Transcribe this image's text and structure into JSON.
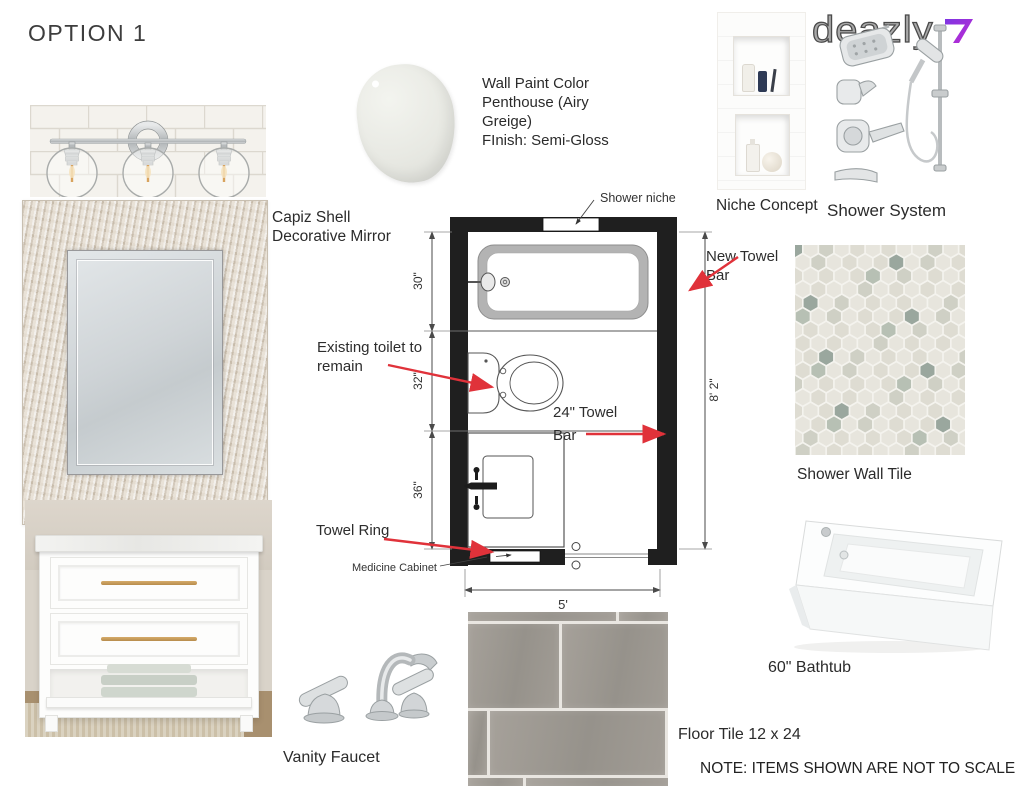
{
  "title": "OPTION 1",
  "logo": {
    "name": "deazly"
  },
  "paint": {
    "line1": "Wall Paint Color",
    "line2": "Penthouse (Airy",
    "line3": "Greige)",
    "line4": "FInish: Semi-Gloss"
  },
  "labels": {
    "capiz_mirror": "Capiz Shell Decorative Mirror",
    "niche_concept": "Niche Concept",
    "shower_system": "Shower System",
    "shower_wall_tile": "Shower Wall Tile",
    "bathtub": "60\" Bathtub",
    "vanity_faucet": "Vanity Faucet",
    "floor_tile": "Floor Tile 12 x 24",
    "note": "NOTE: ITEMS SHOWN ARE NOT TO SCALE"
  },
  "floorplan": {
    "shower_niche": "Shower niche",
    "new_towel_bar": [
      "New Towel",
      "Bar"
    ],
    "existing_toilet": [
      "Existing toilet to",
      "remain"
    ],
    "towel_bar_24": [
      "24\" Towel",
      "Bar"
    ],
    "towel_ring": "Towel Ring",
    "medicine_cabinet": "Medicine Cabinet",
    "dims": {
      "tub": "30\"",
      "toilet": "32\"",
      "vanity": "36\"",
      "room_height": "8' 2\"",
      "room_width": "5'"
    }
  },
  "colors": {
    "annotation_red": "#e0323a",
    "logo_purple": "#8d32dd",
    "wall_black": "#1f1f1f"
  }
}
